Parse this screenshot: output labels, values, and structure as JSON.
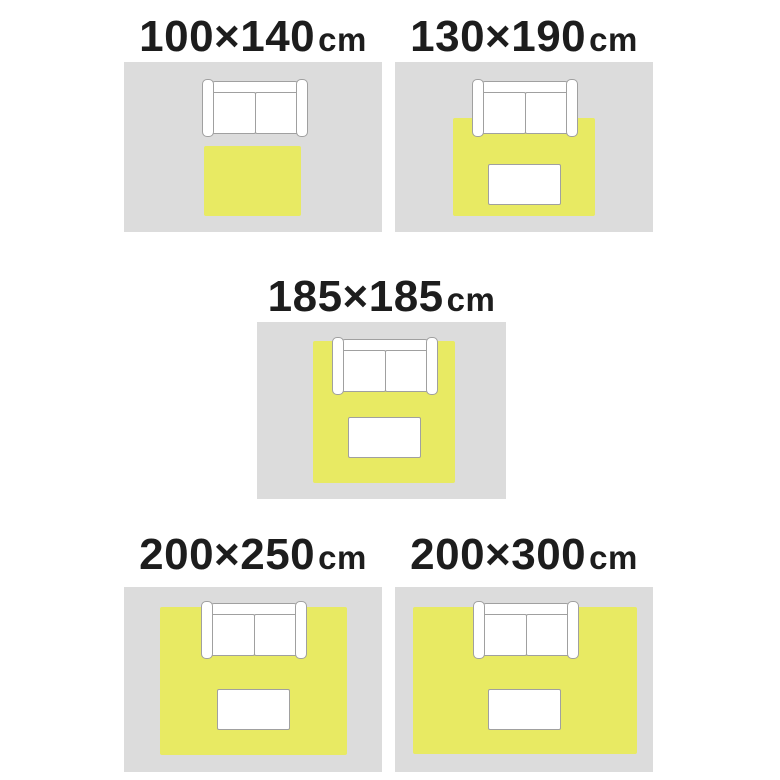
{
  "colors": {
    "background": "#ffffff",
    "floor": "#dcdcdc",
    "rug": "#e8ea63",
    "furniture_fill": "#ffffff",
    "furniture_outline": "#a0a0a0",
    "label_text": "#1d1d1d"
  },
  "panels": [
    {
      "id": "100x140",
      "label": {
        "size": "100×140",
        "unit": "cm"
      },
      "rug_width_cm": 100,
      "rug_length_cm": 140,
      "shows": {
        "rug": true,
        "sofa": true,
        "table": false,
        "sofa_on_rug": false
      }
    },
    {
      "id": "130x190",
      "label": {
        "size": "130×190",
        "unit": "cm"
      },
      "rug_width_cm": 130,
      "rug_length_cm": 190,
      "shows": {
        "rug": true,
        "sofa": true,
        "table": true,
        "sofa_on_rug": true
      }
    },
    {
      "id": "185x185",
      "label": {
        "size": "185×185",
        "unit": "cm"
      },
      "rug_width_cm": 185,
      "rug_length_cm": 185,
      "shows": {
        "rug": true,
        "sofa": true,
        "table": true,
        "sofa_on_rug": true
      }
    },
    {
      "id": "200x250",
      "label": {
        "size": "200×250",
        "unit": "cm"
      },
      "rug_width_cm": 200,
      "rug_length_cm": 250,
      "shows": {
        "rug": true,
        "sofa": true,
        "table": true,
        "sofa_on_rug": true
      }
    },
    {
      "id": "200x300",
      "label": {
        "size": "200×300",
        "unit": "cm"
      },
      "rug_width_cm": 200,
      "rug_length_cm": 300,
      "shows": {
        "rug": true,
        "sofa": true,
        "table": true,
        "sofa_on_rug": true
      }
    }
  ]
}
